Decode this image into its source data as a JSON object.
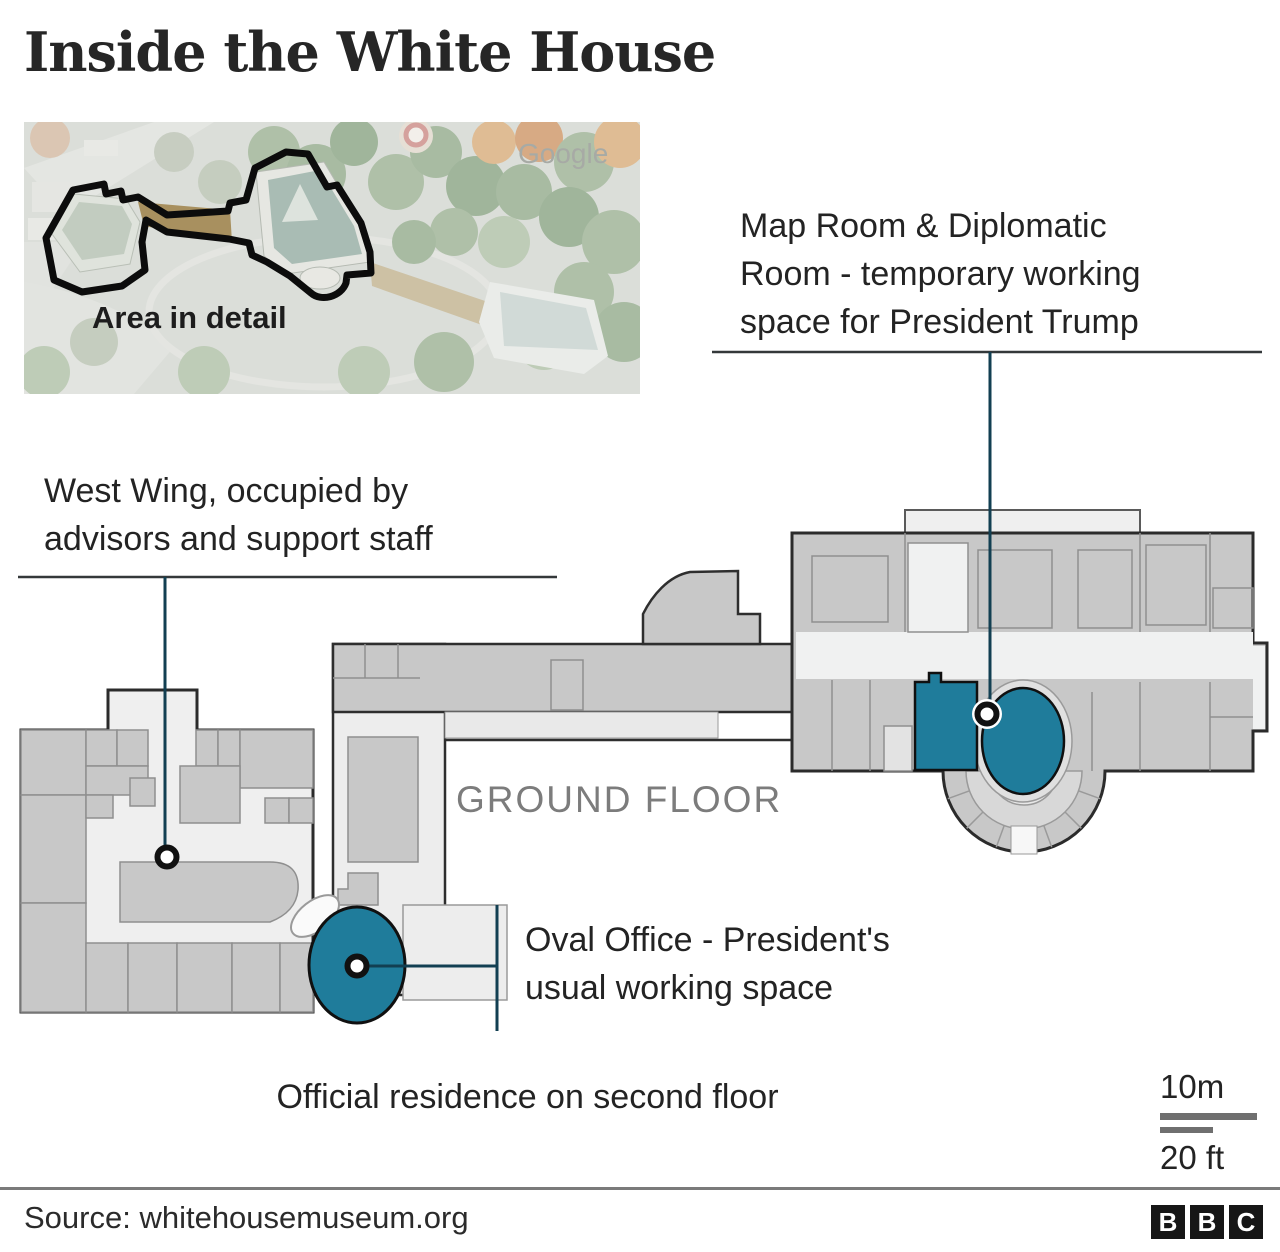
{
  "title": "Inside the White House",
  "satellite": {
    "area_label": "Area in detail",
    "watermark": "Google"
  },
  "annotations": {
    "map_room": "Map Room & Diplomatic\nRoom - temporary working\nspace for President Trump",
    "west_wing": "West Wing, occupied by\nadvisors and support staff",
    "oval_office": "Oval Office - President's\nusual working space",
    "residence": "Official residence on second floor"
  },
  "plan": {
    "floor_label": "GROUND FLOOR"
  },
  "scale": {
    "metric": "10m",
    "imperial": "20 ft"
  },
  "footer": {
    "source": "Source: whitehousemuseum.org",
    "logo": [
      "B",
      "B",
      "C"
    ]
  },
  "colors": {
    "highlight_teal": "#1f7c9b",
    "leader_line": "#123f52",
    "rule_line": "#34383a",
    "room_gray": "#c8c8c8",
    "corridor_gray": "#ededed",
    "outline_dark": "#2b2b2b"
  }
}
